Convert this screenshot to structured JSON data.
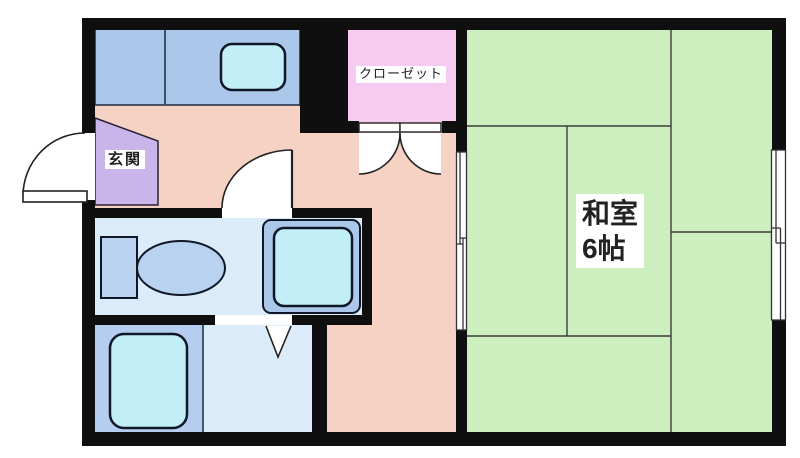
{
  "labels": {
    "closet": "クローゼット",
    "entrance": "玄関",
    "japanese_room_line1": "和室",
    "japanese_room_line2": "6帖"
  },
  "palette": {
    "background": "#ffffff",
    "wall": "#0f0f0f",
    "floor_hall": "#f6d2c4",
    "tatami_green": "#cdeebe",
    "counter_blue": "#abc8ea",
    "fixture_blue": "#b9d2ef",
    "cyan_fixture": "#c2eff7",
    "closet_pink": "#f7cbf1",
    "genkan_purple": "#c9b5e9",
    "wetroom_floor": "#dcebf9",
    "bath_floor": "#b5cdee",
    "door_white": "#ffffff"
  }
}
